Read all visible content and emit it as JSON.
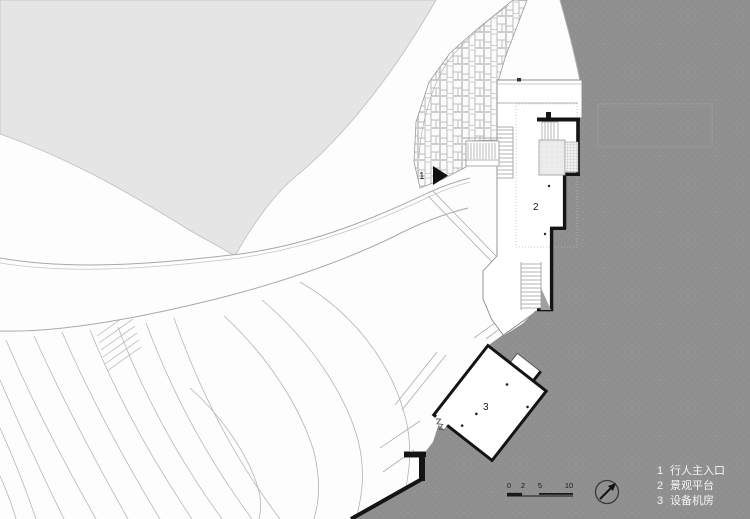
{
  "drawing": {
    "type": "architectural-site-plan",
    "marker_labels": {
      "entrance": "1",
      "platform": "2",
      "equipment": "3"
    },
    "legend": {
      "items": [
        {
          "number": "1",
          "label": "行人主入口"
        },
        {
          "number": "2",
          "label": "景观平台"
        },
        {
          "number": "3",
          "label": "设备机房"
        }
      ]
    },
    "scale_bar": {
      "ticks": [
        "0",
        "2",
        "5",
        "10"
      ]
    },
    "colors": {
      "water": "#8f8f8f",
      "terrain_light": "#e5e5e5",
      "wall": "#141414",
      "thin_line": "#9a9a9a",
      "legend_text": "#f4f4f4"
    }
  }
}
